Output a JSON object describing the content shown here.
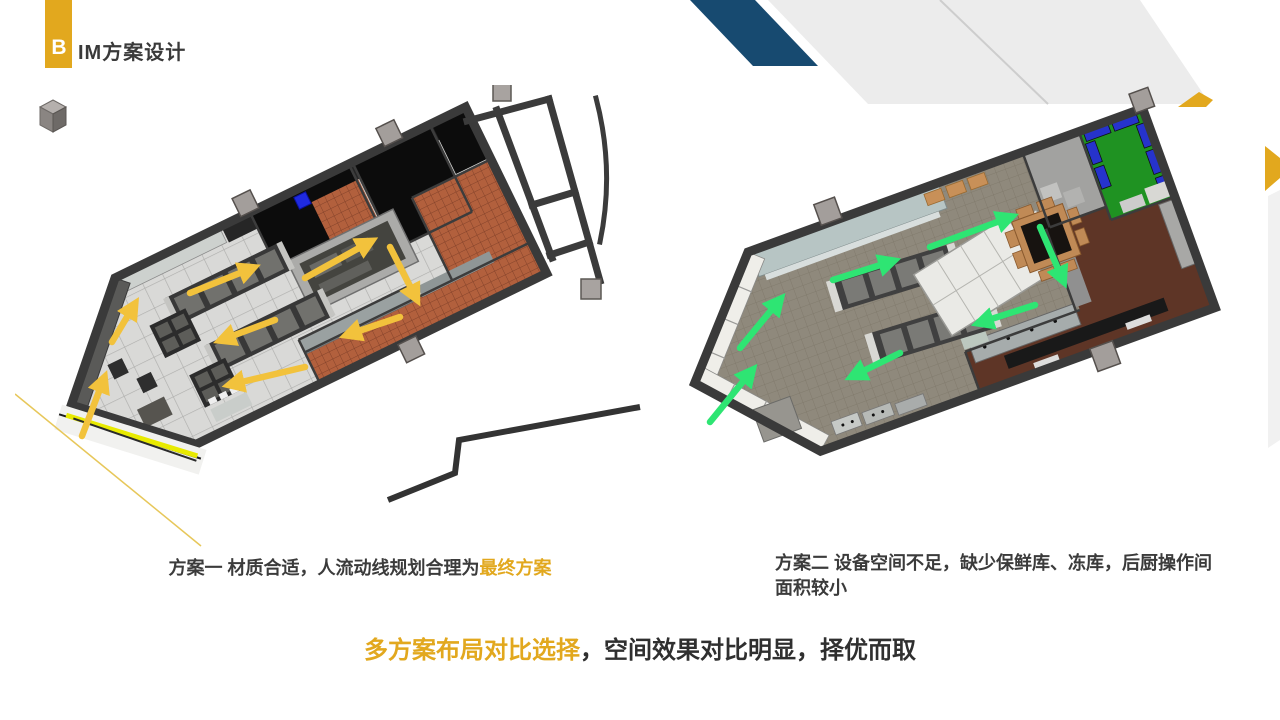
{
  "title": {
    "badge_letter": "B",
    "rest": "IM方案设计"
  },
  "captions": {
    "option1": {
      "prefix": "方案一 材质合适，人流动线规划合理为",
      "highlight": "最终方案"
    },
    "option2": {
      "text": "方案二 设备空间不足，缺少保鲜库、冻库，后厨操作间面积较小"
    }
  },
  "conclusion": {
    "highlight": "多方案布局对比选择",
    "rest": "，空间效果对比明显，择优而取"
  },
  "colors": {
    "accent_gold": "#E2A81E",
    "navy_stripe": "#174A70",
    "gray_stripe": "#ECECEC",
    "text_dark": "#3b3b3b",
    "option1_flow": "#F2C23C",
    "option2_flow": "#2EE573",
    "dining_tile_gray": "#D9D9D7",
    "kitchen_tile_terracotta": "#B2603D",
    "option2_floor_taupe": "#8F897C",
    "option2_kitchen_brown": "#5E3526",
    "green_room": "#1F9222",
    "blue_furniture": "#2633CC",
    "entrance_highlight": "#E8EA00"
  },
  "figures": {
    "option1": {
      "flow_arrows": {
        "color": "#F2C23C",
        "segments": [
          [
            67,
            351,
            88,
            296
          ],
          [
            97,
            257,
            118,
            222
          ],
          [
            175,
            208,
            235,
            184
          ],
          [
            290,
            193,
            353,
            158
          ],
          [
            375,
            162,
            400,
            211
          ],
          [
            385,
            232,
            335,
            249
          ],
          [
            260,
            235,
            209,
            254
          ],
          [
            290,
            282,
            218,
            299
          ]
        ]
      }
    },
    "option2": {
      "flow_arrows": {
        "color": "#2EE573",
        "segments": [
          [
            55,
            337,
            95,
            288
          ],
          [
            85,
            263,
            123,
            217
          ],
          [
            178,
            195,
            235,
            177
          ],
          [
            275,
            162,
            353,
            133
          ],
          [
            385,
            142,
            407,
            193
          ],
          [
            380,
            220,
            327,
            237
          ],
          [
            245,
            268,
            200,
            290
          ]
        ]
      }
    }
  }
}
